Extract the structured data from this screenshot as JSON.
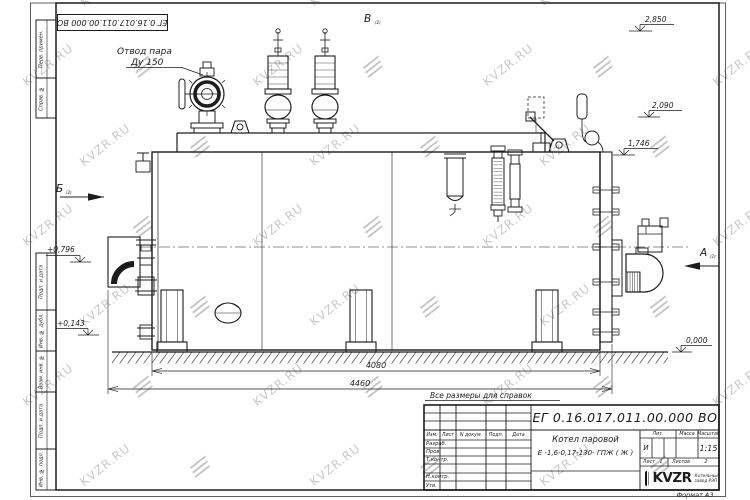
{
  "watermark": {
    "text": "KVZR.RU"
  },
  "corner_stamp": {
    "designation": "ЕГ 0.16.017.011.00.000  ВО"
  },
  "frame_strips": [
    "Перв. примен.",
    "Справ. №",
    "Подп. и дата",
    "Инв. № дубл.",
    "Взам. инв. №",
    "Подп. и дата",
    "Инв. № подл."
  ],
  "drawing": {
    "callout": {
      "line1": "Отвод пара",
      "line2": "Ду 150"
    },
    "views": {
      "top": "В",
      "left": "Б",
      "right": "А",
      "sub": "(2)"
    },
    "levels": [
      "2,850",
      "2,090",
      "1,746",
      "+0,796",
      "+0,143",
      "0,000"
    ],
    "dims": [
      "4080",
      "4460"
    ],
    "note": "Все размеры для справок"
  },
  "title_block": {
    "designation": "ЕГ 0.16.017.011.00.000  ВО",
    "product_name": "Котел паровой",
    "product_type": "Е -1,6-0,17-130- ГПЖ ( Ж )",
    "col_izm": "Изм.",
    "col_list": "Лист",
    "col_doc": "N докум.",
    "col_sign": "Подп.",
    "col_date": "Дата",
    "row_labels": [
      "Разраб.",
      "Пров.",
      "Т.контр.",
      "",
      "Н.контр.",
      "Утв."
    ],
    "lit_header": "Лит.",
    "mass_header": "Масса",
    "scale_header": "Масштаб",
    "lit_value": "И",
    "scale_value": "1:15",
    "sheet_label": "Лист",
    "sheet_number": "1",
    "sheets_label": "Листов",
    "sheets_total": "2",
    "logo": {
      "text": "KVZR",
      "sub1": "Котельный",
      "sub2": "завод РЭП"
    },
    "format_label": "Формат А3"
  }
}
